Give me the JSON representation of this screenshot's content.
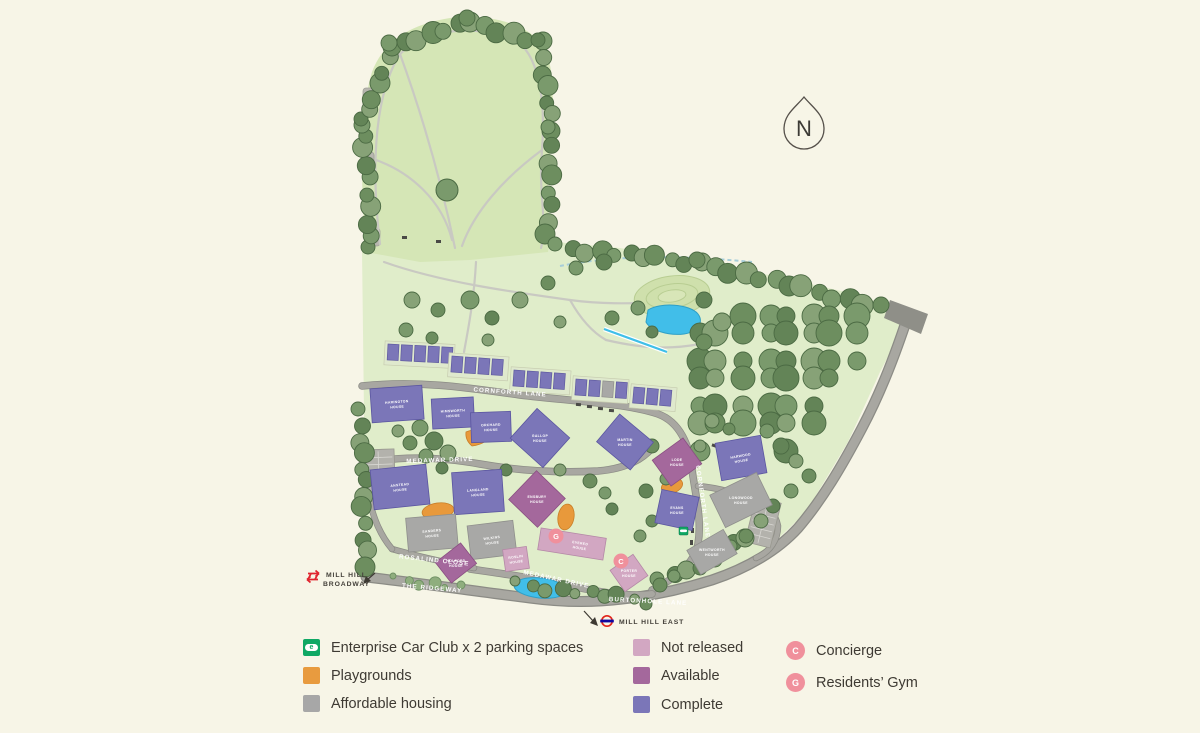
{
  "map": {
    "north_label": "N",
    "stations": {
      "broadway": {
        "line1": "MILL HILL",
        "line2": "BROADWAY"
      },
      "east": {
        "label": "MILL HILL EAST"
      }
    },
    "streets": {
      "cornforth": "CORNFORTH LANE",
      "medawar": "MEDAWAR DRIVE",
      "ridgeway": "THE RIDGEWAY",
      "rosalind": "ROSALIND CLOSE",
      "burtonhole": "BURTONHOLE LANE"
    },
    "badges": {
      "gym": "G",
      "concierge": "C"
    },
    "buildings": {
      "harington": {
        "line1": "HARINGTON",
        "line2": "HOUSE",
        "status": "Complete"
      },
      "himsworth": {
        "line1": "HIMSWORTH",
        "line2": "HOUSE",
        "status": "Complete"
      },
      "orchard": {
        "line1": "ORCHARD",
        "line2": "HOUSE",
        "status": "Complete"
      },
      "gallop": {
        "line1": "GALLOP",
        "line2": "HOUSE",
        "status": "Complete"
      },
      "martin": {
        "line1": "MARTIN",
        "line2": "HOUSE",
        "status": "Complete"
      },
      "lode": {
        "line1": "LODE",
        "line2": "HOUSE",
        "status": "Available"
      },
      "harwood": {
        "line1": "HARWOOD",
        "line2": "HOUSE",
        "status": "Complete"
      },
      "anstead": {
        "line1": "ANSTEAD",
        "line2": "HOUSE",
        "status": "Complete"
      },
      "langland": {
        "line1": "LANGLAND",
        "line2": "HOUSE",
        "status": "Complete"
      },
      "ensbury": {
        "line1": "ENSBURY",
        "line2": "HOUSE",
        "status": "Available"
      },
      "evans": {
        "line1": "EVANS",
        "line2": "HOUSE",
        "status": "Complete"
      },
      "longwood": {
        "line1": "LONGWOOD",
        "line2": "HOUSE",
        "status": "Affordable"
      },
      "sanders": {
        "line1": "SANDERS",
        "line2": "HOUSE",
        "status": "Affordable"
      },
      "wilkins": {
        "line1": "WILKINS",
        "line2": "HOUSE",
        "status": "Affordable"
      },
      "roslin": {
        "line1": "ROSLIN",
        "line2": "HOUSE",
        "status": "Not released"
      },
      "evered": {
        "line1": "EVERED",
        "line2": "HOUSE",
        "status": "Not released"
      },
      "porter": {
        "line1": "PORTER",
        "line2": "HOUSE",
        "status": "Not released"
      },
      "wentworth": {
        "line1": "WENTWORTH",
        "line2": "HOUSE",
        "status": "Affordable"
      },
      "holford": {
        "line1": "HOLFORD",
        "line2": "HOUSE",
        "status": "Available"
      }
    }
  },
  "legend": {
    "car_club": {
      "label": "Enterprise Car Club x 2 parking spaces",
      "letter": "e",
      "color": "#0fa864"
    },
    "playgrounds": {
      "label": "Playgrounds",
      "color": "#e89b3f"
    },
    "affordable": {
      "label": "Affordable housing",
      "color": "#a7a7a7"
    },
    "not_released": {
      "label": "Not released",
      "color": "#d2a7c2"
    },
    "available": {
      "label": "Available",
      "color": "#a4689c"
    },
    "complete": {
      "label": "Complete",
      "color": "#7b76b8"
    },
    "concierge": {
      "letter": "C",
      "label": "Concierge",
      "color": "#f0909c"
    },
    "gym": {
      "letter": "G",
      "label": "Residents’ Gym",
      "color": "#f0909c"
    }
  }
}
